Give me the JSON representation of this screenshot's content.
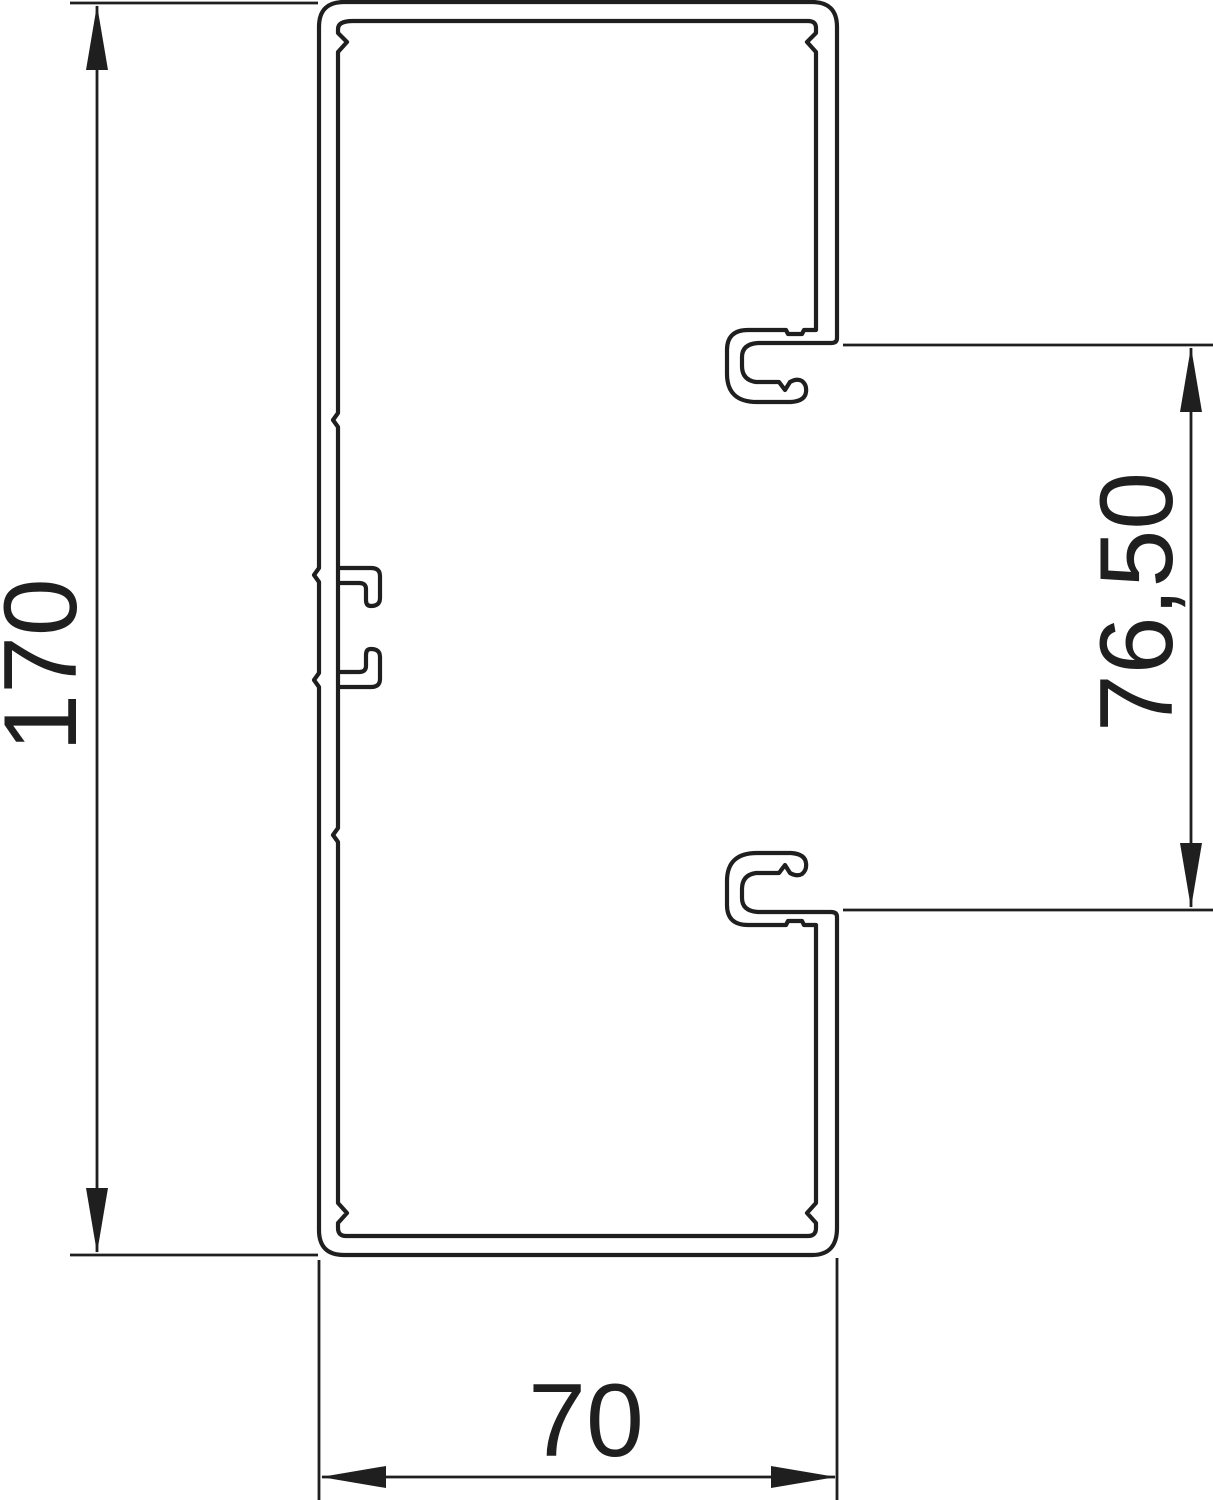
{
  "drawing": {
    "title": "Trunking profile cross-section dimension drawing",
    "line_color": "#1f1f1f",
    "background_color": "#ffffff",
    "dimensions": {
      "overall_height": {
        "label": "170"
      },
      "opening_height": {
        "label": "76,50"
      },
      "overall_width": {
        "label": "70"
      }
    }
  }
}
